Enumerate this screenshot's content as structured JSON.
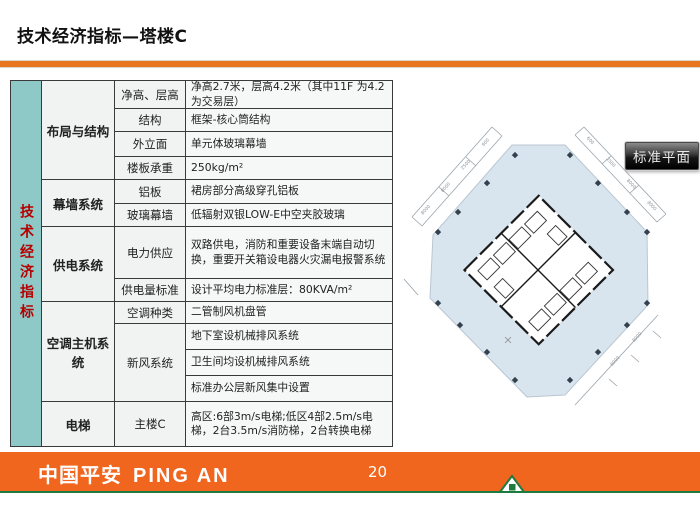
{
  "slide": {
    "title": "技术经济指标—塔楼C",
    "page_number": "20"
  },
  "side_label": "技术经济指标",
  "table": {
    "groups": [
      {
        "label": "布局与结构",
        "rows": [
          {
            "attr": "净高、层高",
            "value": "净高2.7米，层高4.2米（其中11F 为4.2为交易层）"
          },
          {
            "attr": "结构",
            "value": "框架-核心筒结构"
          },
          {
            "attr": "外立面",
            "value": "单元体玻璃幕墙"
          },
          {
            "attr": "楼板承重",
            "value": "250kg/m²"
          }
        ]
      },
      {
        "label": "幕墙系统",
        "rows": [
          {
            "attr": "铝板",
            "value": "裙房部分高级穿孔铝板"
          },
          {
            "attr": "玻璃幕墙",
            "value": "低辐射双银LOW-E中空夹胶玻璃"
          }
        ]
      },
      {
        "label": "供电系统",
        "rows": [
          {
            "attr": "电力供应",
            "value": "双路供电，消防和重要设备末端自动切换，重要开关箱设电器火灾漏电报警系统"
          },
          {
            "attr": "供电量标准",
            "value": "设计平均电力标准层：80KVA/m²"
          }
        ]
      },
      {
        "label": "空调主机系统",
        "rows": [
          {
            "attr": "空调种类",
            "value": "二管制风机盘管"
          },
          {
            "attr": "新风系统",
            "value": "地下室设机械排风系统"
          },
          {
            "value": "卫生间均设机械排风系统"
          },
          {
            "value": "标准办公层新风集中设置"
          }
        ]
      },
      {
        "label": "电梯",
        "rows": [
          {
            "attr": "主楼C",
            "value": "高区:6部3m/s电梯;低区4部2.5m/s电梯，2台3.5m/s消防梯，2台转换电梯"
          }
        ]
      }
    ]
  },
  "floor_plan": {
    "caption": "标准平面",
    "dimensions": {
      "nw": [
        "8000",
        "8000",
        "2500",
        "600"
      ],
      "ne": [
        "600",
        "2500",
        "8000",
        "8000"
      ],
      "se": [
        "8000",
        "8000"
      ]
    }
  },
  "footer": {
    "logo_zh": "中国平安",
    "logo_en": "PING AN"
  },
  "colors": {
    "divider_orange": "#E8761F",
    "footer_orange": "#F0661F",
    "footer_green": "#1E7A3E",
    "side_teal": "#8FC9C7",
    "side_text_red": "#B50000",
    "plan_fill": "#D9E5EE",
    "caption_bg": "#1A1A1A"
  }
}
